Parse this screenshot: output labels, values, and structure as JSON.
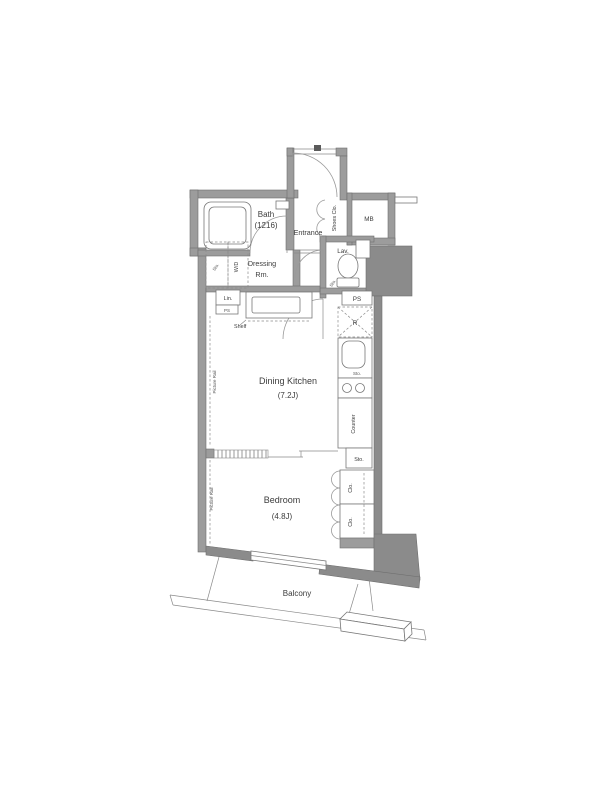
{
  "rooms": {
    "bath": "Bath",
    "bath_size": "(1216)",
    "entrance": "Entrance",
    "shoes_closet": "Shoes Clo.",
    "meter_box": "MB",
    "lavatory": "Lav.",
    "dressing_1": "Dressing",
    "dressing_2": "Rm.",
    "dining_kitchen": "Dining Kitchen",
    "dining_kitchen_size": "(7.2J)",
    "bedroom": "Bedroom",
    "bedroom_size": "(4.8J)",
    "balcony": "Balcony"
  },
  "labels": {
    "washer_dryer": "W/D",
    "storage": "Sto.",
    "linen": "Lin.",
    "pipe_space": "PS",
    "shelf": "Shelf",
    "refrigerator": "R",
    "counter": "Counter",
    "closet": "Clo.",
    "picture_rail": "Picture Rail"
  },
  "colors": {
    "wall": "#9c9c9c",
    "wall_dark": "#8b8b8b",
    "outline": "#6f6f6f",
    "fixture_line": "#787878",
    "text": "#3c3c3c",
    "background": "#ffffff"
  }
}
